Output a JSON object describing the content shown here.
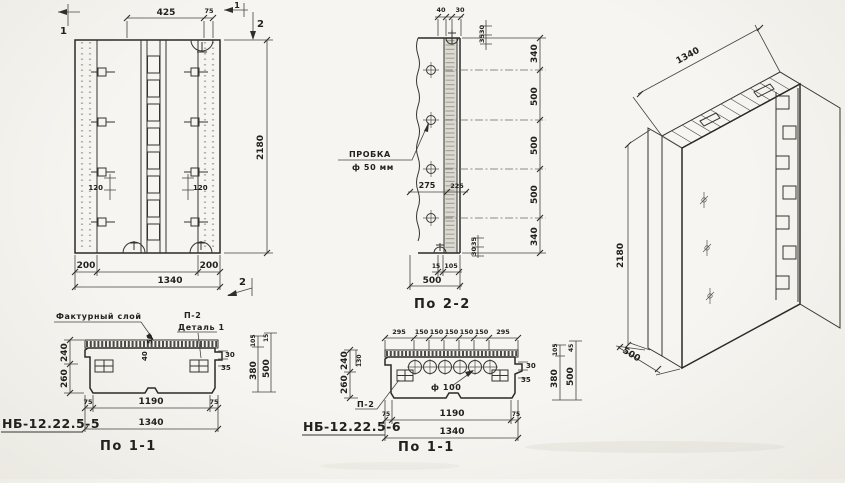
{
  "v1": {
    "flag_top_left": "1",
    "flag_top_right": "1",
    "flag2_top": "2",
    "flag2_bottom": "2",
    "dim_425": "425",
    "dim_75": "75",
    "dim_2180": "2180",
    "dim_200_l": "200",
    "dim_200_r": "200",
    "dim_1340": "1340",
    "dim_120_l": "120",
    "dim_120_r": "120"
  },
  "v2": {
    "caption": "По 2-2",
    "probka1": "ПРОБКА",
    "probka2": "ф 50 мм",
    "dim_40": "40",
    "dim_30_top": "30",
    "small_top": [
      "30",
      "35"
    ],
    "chain": [
      "340",
      "500",
      "500",
      "500",
      "340"
    ],
    "small_bottom": [
      "35",
      "30"
    ],
    "dim_275": "275",
    "dim_225": "225",
    "dim_15": "15",
    "dim_105": "105",
    "dim_500": "500"
  },
  "v3": {
    "dim_w": "1340",
    "dim_h": "2180",
    "dim_d": "500"
  },
  "v4": {
    "mark": "НБ-12.22.5-5",
    "caption": "По 1-1",
    "label_factur": "Фактурный слой",
    "label_p2": "П-2",
    "label_detail": "Деталь 1",
    "dim_50": "50",
    "dim_40": "40",
    "dim_30": "30",
    "dim_35": "35",
    "dim_240": "240",
    "dim_260": "260",
    "chain_105": "105",
    "chain_15": "15",
    "chain_380": "380",
    "chain_500": "500",
    "dim_75_l": "75",
    "dim_1190": "1190",
    "dim_75_r": "75",
    "dim_1340": "1340"
  },
  "v5": {
    "mark": "НБ-12.22.5-6",
    "caption": "По 1-1",
    "label_p2": "П-2",
    "label_phi": "ф 100",
    "top_chain": [
      "295",
      "150",
      "150",
      "150",
      "150",
      "150",
      "295"
    ],
    "dim_130": "130",
    "dim_240": "240",
    "dim_260": "260",
    "dim_30": "30",
    "dim_35": "35",
    "chain_105": "105",
    "chain_45": "45",
    "chain_380": "380",
    "chain_500": "500",
    "dim_75_l": "75",
    "dim_1190": "1190",
    "dim_75_r": "75",
    "dim_1340": "1340"
  }
}
